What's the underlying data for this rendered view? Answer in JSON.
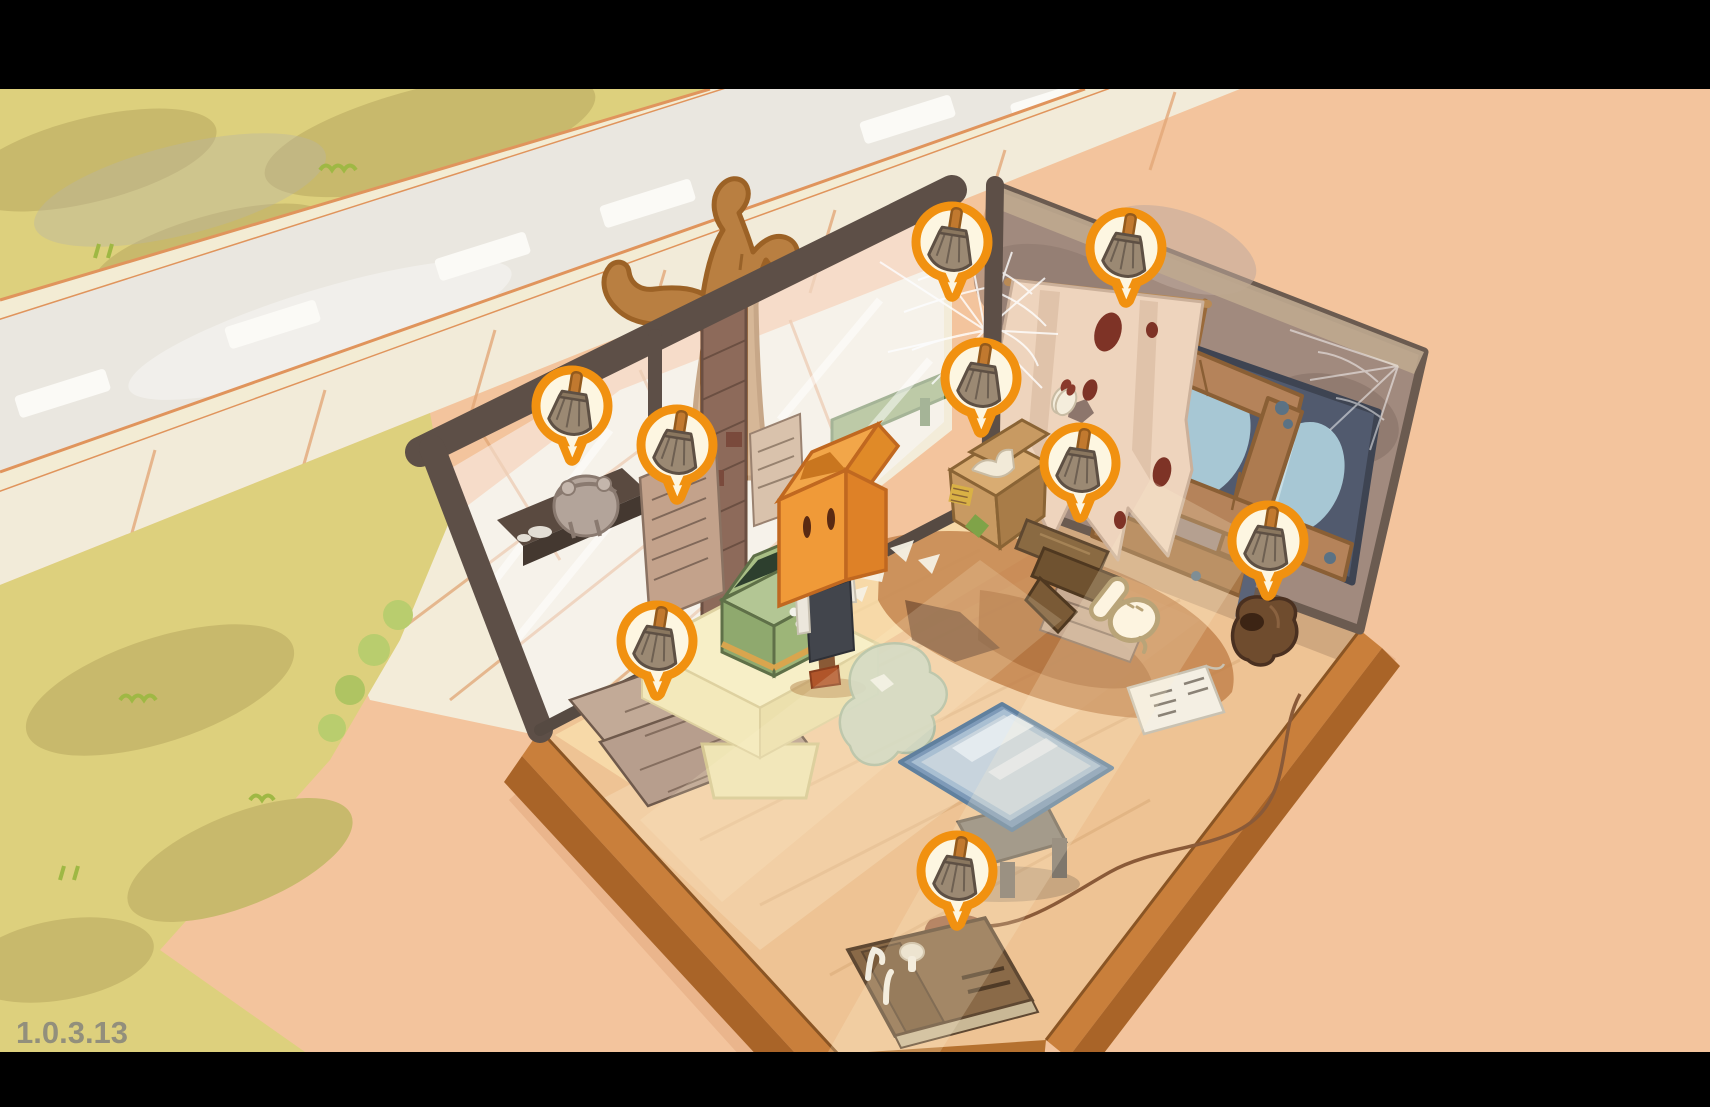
{
  "app": {
    "version_label": "1.0.3.13"
  },
  "hud": {
    "markers": [
      {
        "id": "marker-cobweb-top",
        "icon": "broom",
        "transform": "translate(952 242)"
      },
      {
        "id": "marker-cloth",
        "icon": "broom",
        "transform": "translate(1126 248)"
      },
      {
        "id": "marker-corner-web",
        "icon": "broom",
        "transform": "translate(981 378)"
      },
      {
        "id": "marker-shelf-statue",
        "icon": "broom",
        "transform": "translate(572 406)"
      },
      {
        "id": "marker-wall-newspaper",
        "icon": "broom",
        "transform": "translate(677 445)"
      },
      {
        "id": "marker-cardboard-box",
        "icon": "broom",
        "transform": "translate(1080 463)"
      },
      {
        "id": "marker-boarded-window",
        "icon": "broom",
        "transform": "translate(1268 541)"
      },
      {
        "id": "marker-counter",
        "icon": "broom",
        "transform": "translate(657 641)"
      },
      {
        "id": "marker-moldy-book",
        "icon": "broom",
        "transform": "translate(957 871)"
      }
    ],
    "cursor": {
      "icon": "hand-pointer",
      "transform": "translate(1126 614)"
    }
  },
  "colors": {
    "letterbox": "#000000",
    "marker_ring": "#F19110",
    "marker_fill": "#FDF6E1",
    "ground_peach": "#F3C49D",
    "grass_yellow": "#DDD07D",
    "floor_wood": "#EEC394",
    "wall_grunge": "#A18A7E"
  }
}
